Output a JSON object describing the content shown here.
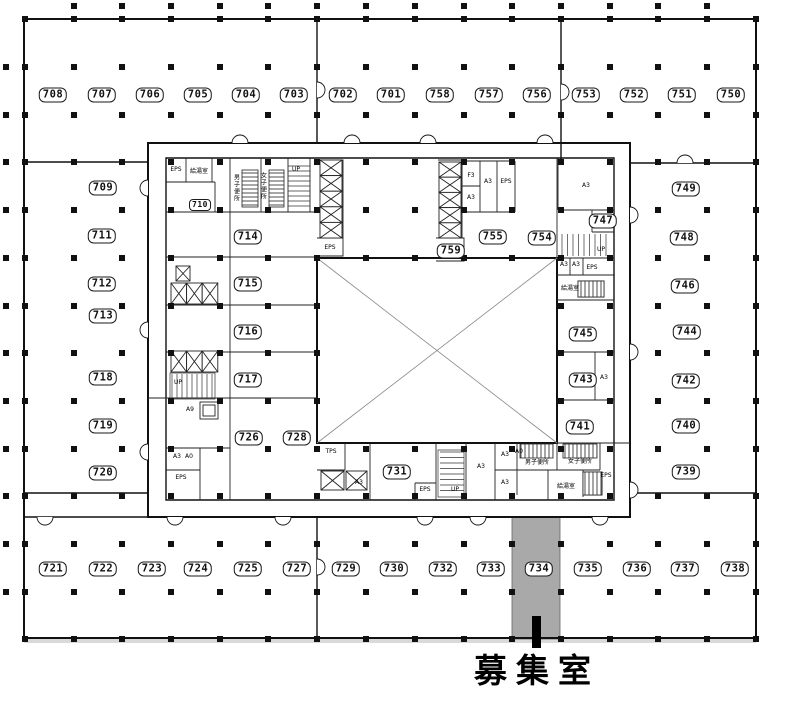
{
  "annotation": {
    "available_label": "募集室",
    "highlighted_room": "734",
    "highlight_color": "#a9a9a9"
  },
  "rooms": [
    {
      "n": "708",
      "x": 53,
      "y": 95
    },
    {
      "n": "707",
      "x": 102,
      "y": 95
    },
    {
      "n": "706",
      "x": 150,
      "y": 95
    },
    {
      "n": "705",
      "x": 198,
      "y": 95
    },
    {
      "n": "704",
      "x": 246,
      "y": 95
    },
    {
      "n": "703",
      "x": 294,
      "y": 95
    },
    {
      "n": "702",
      "x": 343,
      "y": 95
    },
    {
      "n": "701",
      "x": 391,
      "y": 95
    },
    {
      "n": "758",
      "x": 440,
      "y": 95
    },
    {
      "n": "757",
      "x": 489,
      "y": 95
    },
    {
      "n": "756",
      "x": 537,
      "y": 95
    },
    {
      "n": "753",
      "x": 586,
      "y": 95
    },
    {
      "n": "752",
      "x": 634,
      "y": 95
    },
    {
      "n": "751",
      "x": 682,
      "y": 95
    },
    {
      "n": "750",
      "x": 731,
      "y": 95
    },
    {
      "n": "709",
      "x": 103,
      "y": 188
    },
    {
      "n": "711",
      "x": 102,
      "y": 236
    },
    {
      "n": "712",
      "x": 102,
      "y": 284
    },
    {
      "n": "713",
      "x": 103,
      "y": 316
    },
    {
      "n": "718",
      "x": 103,
      "y": 378
    },
    {
      "n": "719",
      "x": 103,
      "y": 426
    },
    {
      "n": "720",
      "x": 103,
      "y": 473
    },
    {
      "n": "714",
      "x": 248,
      "y": 237
    },
    {
      "n": "715",
      "x": 248,
      "y": 284
    },
    {
      "n": "716",
      "x": 248,
      "y": 332
    },
    {
      "n": "717",
      "x": 248,
      "y": 380
    },
    {
      "n": "726",
      "x": 249,
      "y": 438
    },
    {
      "n": "728",
      "x": 297,
      "y": 438
    },
    {
      "n": "731",
      "x": 397,
      "y": 472
    },
    {
      "n": "759",
      "x": 451,
      "y": 251
    },
    {
      "n": "755",
      "x": 493,
      "y": 237
    },
    {
      "n": "754",
      "x": 542,
      "y": 238
    },
    {
      "n": "747",
      "x": 603,
      "y": 221
    },
    {
      "n": "745",
      "x": 583,
      "y": 334
    },
    {
      "n": "743",
      "x": 583,
      "y": 380
    },
    {
      "n": "741",
      "x": 580,
      "y": 427
    },
    {
      "n": "749",
      "x": 686,
      "y": 189
    },
    {
      "n": "748",
      "x": 684,
      "y": 238
    },
    {
      "n": "746",
      "x": 685,
      "y": 286
    },
    {
      "n": "744",
      "x": 687,
      "y": 332
    },
    {
      "n": "742",
      "x": 686,
      "y": 381
    },
    {
      "n": "740",
      "x": 686,
      "y": 426
    },
    {
      "n": "739",
      "x": 686,
      "y": 472
    },
    {
      "n": "721",
      "x": 53,
      "y": 569
    },
    {
      "n": "722",
      "x": 103,
      "y": 569
    },
    {
      "n": "723",
      "x": 152,
      "y": 569
    },
    {
      "n": "724",
      "x": 198,
      "y": 569
    },
    {
      "n": "725",
      "x": 248,
      "y": 569
    },
    {
      "n": "727",
      "x": 297,
      "y": 569
    },
    {
      "n": "729",
      "x": 346,
      "y": 569
    },
    {
      "n": "730",
      "x": 394,
      "y": 569
    },
    {
      "n": "732",
      "x": 443,
      "y": 569
    },
    {
      "n": "733",
      "x": 491,
      "y": 569
    },
    {
      "n": "734",
      "x": 539,
      "y": 569
    },
    {
      "n": "735",
      "x": 588,
      "y": 569
    },
    {
      "n": "736",
      "x": 637,
      "y": 569
    },
    {
      "n": "737",
      "x": 685,
      "y": 569
    },
    {
      "n": "738",
      "x": 735,
      "y": 569
    }
  ],
  "small_room": {
    "n": "710",
    "x": 200,
    "y": 205
  },
  "labels": [
    {
      "t": "EPS",
      "x": 176,
      "y": 170
    },
    {
      "t": "給湯室",
      "x": 199,
      "y": 172
    },
    {
      "t": "男子便所",
      "x": 236,
      "y": 188,
      "v": 1
    },
    {
      "t": "女子便所",
      "x": 263,
      "y": 186,
      "v": 1
    },
    {
      "t": "UP",
      "x": 296,
      "y": 170
    },
    {
      "t": "EPS",
      "x": 330,
      "y": 248
    },
    {
      "t": "F3",
      "x": 471,
      "y": 176
    },
    {
      "t": "A3",
      "x": 471,
      "y": 198
    },
    {
      "t": "A3",
      "x": 488,
      "y": 182
    },
    {
      "t": "EPS",
      "x": 506,
      "y": 182
    },
    {
      "t": "A3",
      "x": 586,
      "y": 186
    },
    {
      "t": "UP",
      "x": 601,
      "y": 250
    },
    {
      "t": "A3",
      "x": 564,
      "y": 265
    },
    {
      "t": "A3",
      "x": 576,
      "y": 265
    },
    {
      "t": "EPS",
      "x": 592,
      "y": 268
    },
    {
      "t": "給湯室",
      "x": 570,
      "y": 289
    },
    {
      "t": "A3",
      "x": 604,
      "y": 378
    },
    {
      "t": "A9",
      "x": 190,
      "y": 410
    },
    {
      "t": "A3",
      "x": 177,
      "y": 457
    },
    {
      "t": "A0",
      "x": 189,
      "y": 457
    },
    {
      "t": "EPS",
      "x": 181,
      "y": 478
    },
    {
      "t": "UP",
      "x": 178,
      "y": 383
    },
    {
      "t": "TPS",
      "x": 331,
      "y": 452
    },
    {
      "t": "A3",
      "x": 359,
      "y": 483
    },
    {
      "t": "EPS",
      "x": 425,
      "y": 490
    },
    {
      "t": "UP",
      "x": 455,
      "y": 490
    },
    {
      "t": "A3",
      "x": 481,
      "y": 467
    },
    {
      "t": "A3",
      "x": 505,
      "y": 455
    },
    {
      "t": "A3",
      "x": 505,
      "y": 483
    },
    {
      "t": "A0",
      "x": 519,
      "y": 452
    },
    {
      "t": "男子便所",
      "x": 537,
      "y": 463
    },
    {
      "t": "女子便所",
      "x": 580,
      "y": 462
    },
    {
      "t": "給湯室",
      "x": 566,
      "y": 487
    },
    {
      "t": "EPS",
      "x": 606,
      "y": 476
    }
  ]
}
